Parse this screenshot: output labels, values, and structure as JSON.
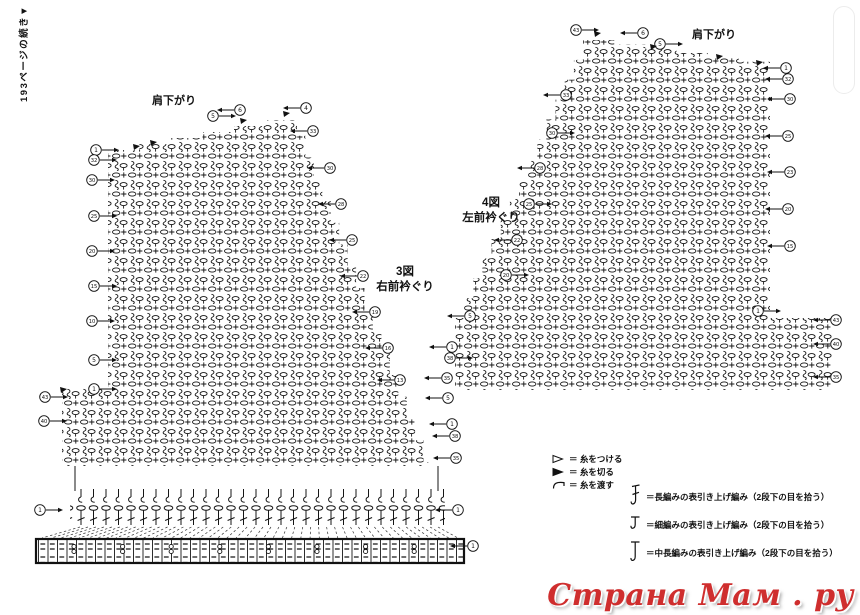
{
  "note": "193ページの続き▼",
  "watermark": {
    "text": "Страна Мам . ру",
    "color": "#cf2e2e"
  },
  "legend_yarn": [
    {
      "icon": "attach-yarn-symbol",
      "text": "＝ 糸をつける"
    },
    {
      "icon": "cut-yarn-symbol",
      "text": "＝ 糸を切る"
    },
    {
      "icon": "carry-yarn-symbol",
      "text": "＝ 糸を渡す"
    }
  ],
  "legend_stitches": [
    {
      "icon": "front-post-treble-symbol",
      "text": "＝長編みの表引き上げ編み（2段下の目を拾う）"
    },
    {
      "icon": "front-post-single-symbol",
      "text": "＝細編みの表引き上げ編み（2段下の目を拾う）"
    },
    {
      "icon": "front-post-half-symbol",
      "text": "＝中長編みの表引き上げ編み（2段下の目を拾う）"
    }
  ],
  "fig3": {
    "number": "3図",
    "name": "右前衿ぐり",
    "shoulder": "肩下がり",
    "shape": {
      "leftX": 108,
      "topLeftY": 150,
      "peakX": 297,
      "peakY": 114,
      "neckEndX": 432,
      "neckEndY": 462,
      "bottomY": 466,
      "extLeftX": 62,
      "extTopY": 388,
      "topSteps": 6,
      "neckSteps": 16,
      "strip": [
        70,
        489,
        375,
        36
      ],
      "band": [
        36,
        539,
        428,
        24
      ],
      "fan": {
        "x1a": 80,
        "x1b": 438,
        "y1": 527,
        "x2a": 42,
        "x2b": 458,
        "y2": 538,
        "n": 46
      },
      "buttons": {
        "x0": 74,
        "dx": 48.6,
        "xmax": 456,
        "y": 546.5
      }
    },
    "cuts": [
      [
        133,
        147
      ],
      [
        150,
        143
      ],
      [
        240,
        121
      ],
      [
        283,
        114
      ],
      [
        60,
        390
      ]
    ],
    "markers": [
      {
        "n": "1",
        "x": 96,
        "y": 150,
        "dir": "r"
      },
      {
        "n": "32",
        "x": 94,
        "y": 160,
        "dir": "r"
      },
      {
        "n": "30",
        "x": 92,
        "y": 180,
        "dir": "r"
      },
      {
        "n": "25",
        "x": 94,
        "y": 216,
        "dir": "r"
      },
      {
        "n": "20",
        "x": 92,
        "y": 251,
        "dir": "r"
      },
      {
        "n": "15",
        "x": 94,
        "y": 286,
        "dir": "r"
      },
      {
        "n": "10",
        "x": 92,
        "y": 321,
        "dir": "r"
      },
      {
        "n": "5",
        "x": 94,
        "y": 360,
        "dir": "r"
      },
      {
        "n": "1",
        "x": 94,
        "y": 389,
        "dir": "r"
      },
      {
        "n": "43",
        "x": 45,
        "y": 397,
        "dir": "r"
      },
      {
        "n": "40",
        "x": 44,
        "y": 421,
        "dir": "r"
      },
      {
        "n": "5",
        "x": 213,
        "y": 116,
        "dir": "r"
      },
      {
        "n": "6",
        "x": 240,
        "y": 110,
        "dir": "l"
      },
      {
        "n": "4",
        "x": 306,
        "y": 108,
        "dir": "l"
      },
      {
        "n": "33",
        "x": 313,
        "y": 131,
        "dir": "l"
      },
      {
        "n": "30",
        "x": 330,
        "y": 168,
        "dir": "l"
      },
      {
        "n": "28",
        "x": 341,
        "y": 204,
        "dir": "l"
      },
      {
        "n": "25",
        "x": 352,
        "y": 240,
        "dir": "l"
      },
      {
        "n": "22",
        "x": 363,
        "y": 276,
        "dir": "l"
      },
      {
        "n": "19",
        "x": 375,
        "y": 312,
        "dir": "l"
      },
      {
        "n": "16",
        "x": 388,
        "y": 348,
        "dir": "l"
      },
      {
        "n": "13",
        "x": 400,
        "y": 380,
        "dir": "l"
      },
      {
        "n": "5",
        "x": 448,
        "y": 398,
        "dir": "l"
      },
      {
        "n": "1",
        "x": 452,
        "y": 424,
        "dir": "l"
      },
      {
        "n": "38",
        "x": 455,
        "y": 436,
        "dir": "l"
      },
      {
        "n": "35",
        "x": 456,
        "y": 458,
        "dir": "l"
      },
      {
        "n": "1",
        "x": 40,
        "y": 510,
        "dir": "r"
      },
      {
        "n": "1",
        "x": 458,
        "y": 510,
        "dir": "l"
      },
      {
        "n": "1",
        "x": 473,
        "y": 546,
        "dir": "l"
      }
    ]
  },
  "fig4": {
    "number": "4図",
    "name": "左前衿ぐり",
    "shoulder": "肩下がり",
    "shape": {
      "peakX": 583,
      "peakY": 40,
      "topEndX": 770,
      "topEndY": 66,
      "rightX": 770,
      "extRightX": 832,
      "extTopY": 318,
      "bottomY": 390,
      "leftX": 455,
      "topSteps": 6,
      "neckSteps": 14
    },
    "cuts": [
      [
        594,
        34
      ],
      [
        650,
        47
      ],
      [
        716,
        57
      ],
      [
        756,
        63
      ]
    ],
    "markers": [
      {
        "n": "43",
        "x": 576,
        "y": 30,
        "dir": "r"
      },
      {
        "n": "6",
        "x": 643,
        "y": 33,
        "dir": "l"
      },
      {
        "n": "5",
        "x": 660,
        "y": 44,
        "dir": "r"
      },
      {
        "n": "1",
        "x": 786,
        "y": 68,
        "dir": "l"
      },
      {
        "n": "32",
        "x": 788,
        "y": 79,
        "dir": "l"
      },
      {
        "n": "30",
        "x": 790,
        "y": 99,
        "dir": "l"
      },
      {
        "n": "25",
        "x": 788,
        "y": 136,
        "dir": "l"
      },
      {
        "n": "23",
        "x": 790,
        "y": 172,
        "dir": "l"
      },
      {
        "n": "20",
        "x": 788,
        "y": 209,
        "dir": "l"
      },
      {
        "n": "15",
        "x": 790,
        "y": 246,
        "dir": "l"
      },
      {
        "n": "33",
        "x": 566,
        "y": 95,
        "dir": "l"
      },
      {
        "n": "30",
        "x": 552,
        "y": 133,
        "dir": "r"
      },
      {
        "n": "28",
        "x": 540,
        "y": 168,
        "dir": "l"
      },
      {
        "n": "25",
        "x": 529,
        "y": 204,
        "dir": "r"
      },
      {
        "n": "22",
        "x": 517,
        "y": 240,
        "dir": "l"
      },
      {
        "n": "20",
        "x": 506,
        "y": 275,
        "dir": "r"
      },
      {
        "n": "5",
        "x": 470,
        "y": 316,
        "dir": "l"
      },
      {
        "n": "1",
        "x": 452,
        "y": 347,
        "dir": "l"
      },
      {
        "n": "38",
        "x": 450,
        "y": 358,
        "dir": "r"
      },
      {
        "n": "35",
        "x": 447,
        "y": 378,
        "dir": "l"
      },
      {
        "n": "1",
        "x": 758,
        "y": 311,
        "dir": "r"
      },
      {
        "n": "43",
        "x": 836,
        "y": 320,
        "dir": "l"
      },
      {
        "n": "40",
        "x": 836,
        "y": 344,
        "dir": "l"
      },
      {
        "n": "35",
        "x": 836,
        "y": 377,
        "dir": "l"
      }
    ]
  }
}
